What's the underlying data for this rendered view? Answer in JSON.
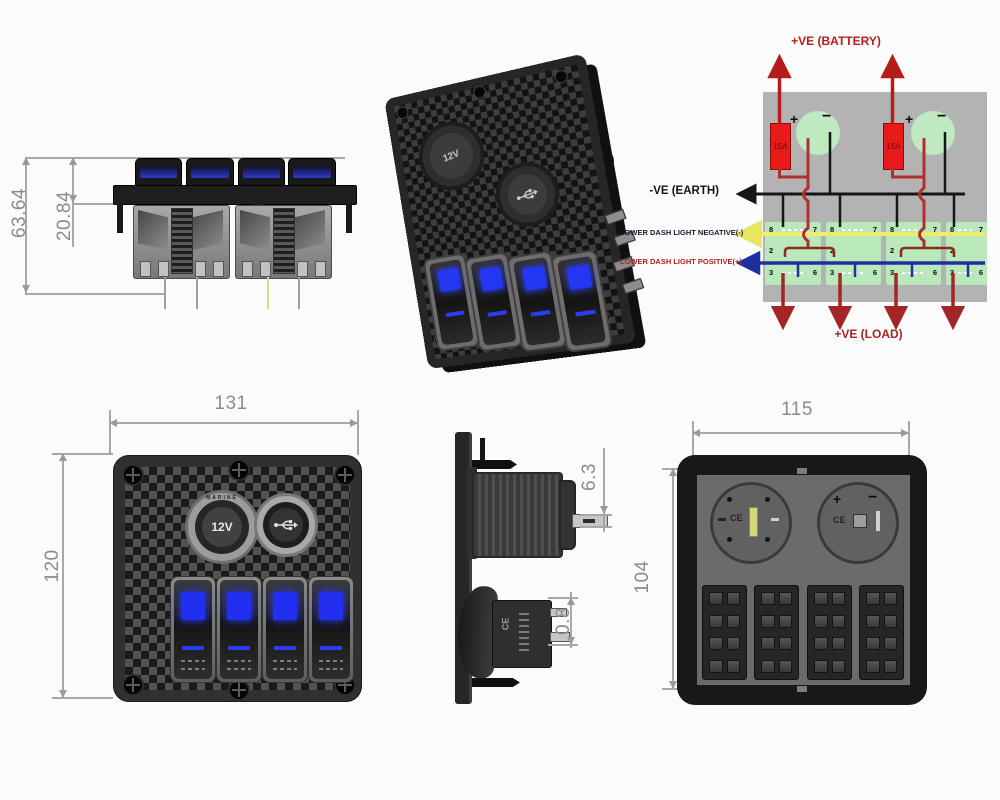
{
  "side_view": {
    "dim_height_total": "63.64",
    "dim_height_upper": "20.84"
  },
  "perspective_view": {
    "socket_label": "12V"
  },
  "wiring_diagram": {
    "label_battery": "+VE (BATTERY)",
    "label_earth": "-VE (EARTH)",
    "label_dash_negative": "LOWER DASH LIGHT NEGATIVE(-)",
    "label_dash_positive": "LOWER DASH LIGHT POSITIVE(+)",
    "label_load": "+VE (LOAD)",
    "fuse_rating": "15A",
    "plus": "+",
    "minus": "−",
    "terminal_8": "8",
    "terminal_7": "7",
    "terminal_2": "2",
    "terminal_3": "3",
    "terminal_6": "6"
  },
  "front_view": {
    "dim_width": "131",
    "dim_height": "120",
    "socket_label": "12V",
    "socket_arc_text": "MARINE"
  },
  "socket_side_view": {
    "dim_terminal": "6.3",
    "dim_terminal_small": "0.8",
    "ce_mark": "CE"
  },
  "rear_view": {
    "dim_width": "115",
    "dim_height": "104",
    "ce_mark": "CE",
    "plus": "+",
    "minus": "−"
  },
  "colors": {
    "wire_red": "#b03030",
    "wire_black": "#161616",
    "wire_yellow": "#efec6f",
    "wire_blue": "#1e2fa0",
    "fuse_red": "#e81a1a",
    "socket_green": "#bfe9c0",
    "panel_gray": "#b3b3b3",
    "label_red": "#b32020",
    "led_blue": "#2130f0",
    "dim_gray": "#8c8c8c"
  }
}
